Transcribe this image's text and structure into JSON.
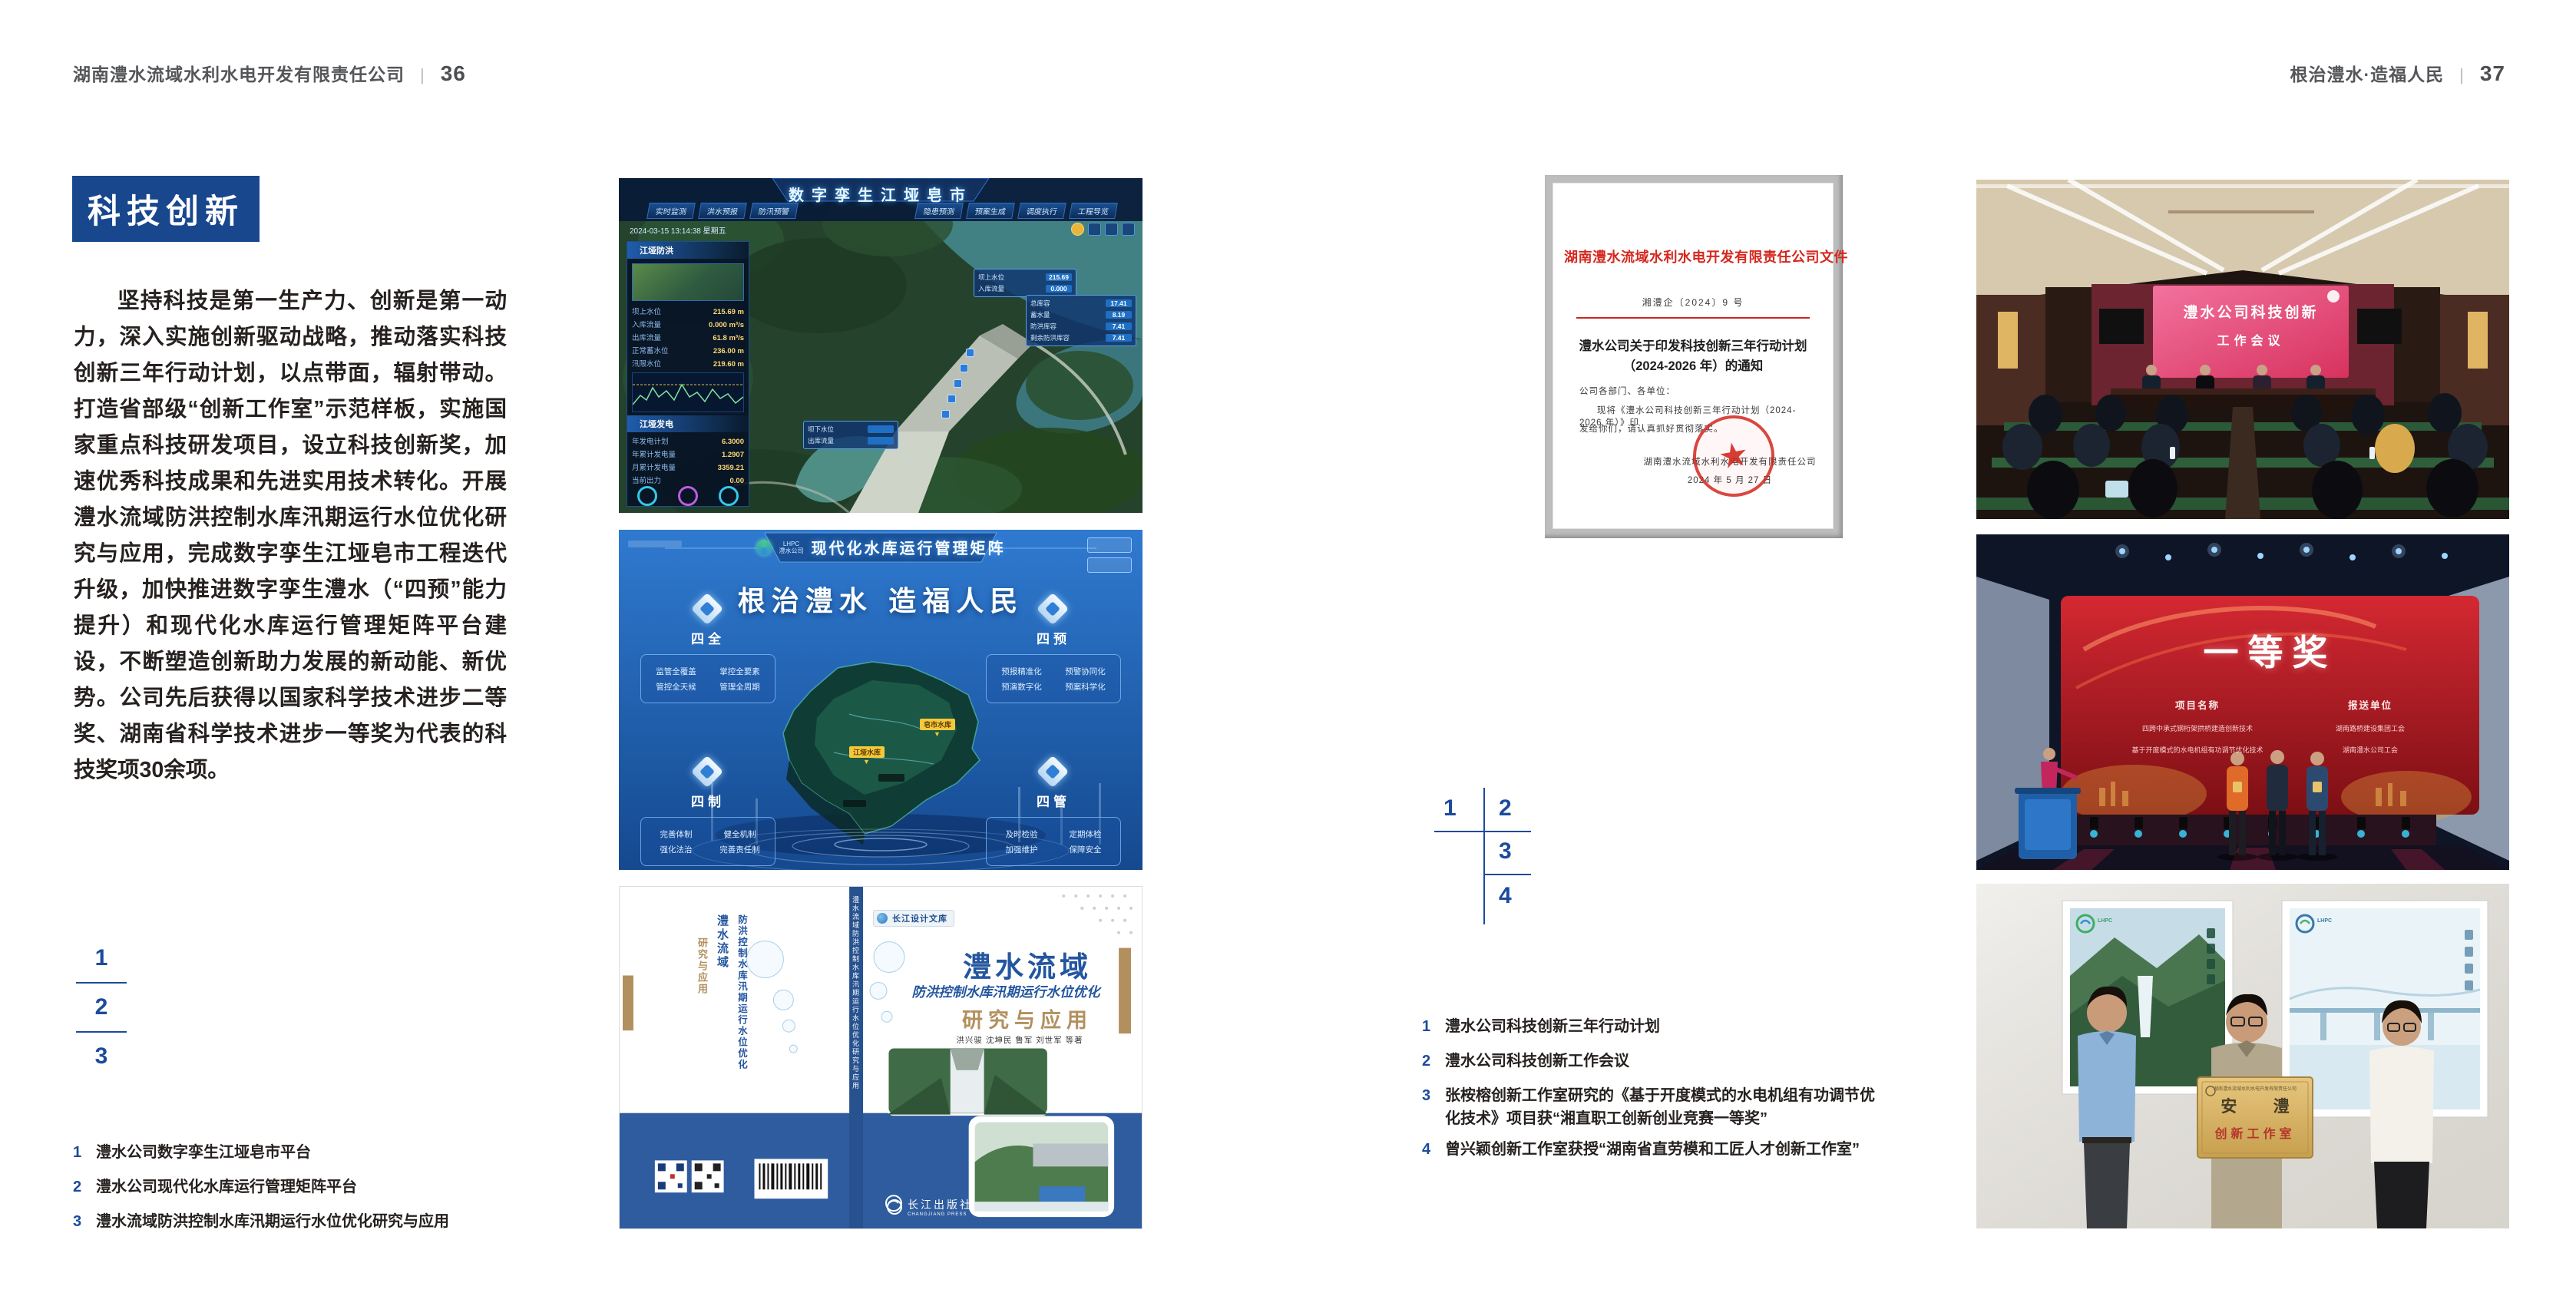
{
  "page_left": {
    "header": {
      "company": "湖南澧水流域水利水电开发有限责任公司",
      "divider": "|",
      "page_num": "36"
    },
    "section_title": "科技创新",
    "paragraph": "坚持科技是第一生产力、创新是第一动力，深入实施创新驱动战略，推动落实科技创新三年行动计划，以点带面，辐射带动。打造省部级“创新工作室”示范样板，实施国家重点科技研发项目，设立科技创新奖，加速优秀科技成果和先进实用技术转化。开展澧水流域防洪控制水库汛期运行水位优化研究与应用，完成数字孪生江垭皂市工程迭代升级，加快推进数字孪生澧水（“四预”能力提升）和现代化水库运行管理矩阵平台建设，不断塑造创新助力发展的新动能、新优势。公司先后获得以国家科学技术进步二等奖、湖南省科学技术进步一等奖为代表的科技奖项30余项。",
    "figure_index": [
      "1",
      "2",
      "3"
    ],
    "captions": [
      {
        "num": "1",
        "text": "澧水公司数字孪生江垭皂市平台"
      },
      {
        "num": "2",
        "text": "澧水公司现代化水库运行管理矩阵平台"
      },
      {
        "num": "3",
        "text": "澧水流域防洪控制水库汛期运行水位优化研究与应用"
      }
    ]
  },
  "page_right": {
    "header": {
      "slogan": "根治澧水·造福人民",
      "divider": "|",
      "page_num": "37"
    },
    "figure_index": [
      "1",
      "2",
      "3",
      "4"
    ],
    "captions": [
      {
        "num": "1",
        "text": "澧水公司科技创新三年行动计划"
      },
      {
        "num": "2",
        "text": "澧水公司科技创新工作会议"
      },
      {
        "num": "3",
        "text": "张桉榕创新工作室研究的《基于开度模式的水电机组有功调节优化技术》项目获“湘直职工创新创业竞赛一等奖”"
      },
      {
        "num": "4",
        "text": "曾兴颖创新工作室获授“湖南省直劳模和工匠人才创新工作室”"
      }
    ]
  },
  "figures": {
    "dashboard": {
      "title": "数字孪生江垭皂市",
      "timestamp": "2024-03-15 13:14:38 星期五",
      "tabs_left": [
        "实时监测",
        "洪水预报",
        "防汛预警"
      ],
      "tabs_right": [
        "隐患预测",
        "预案生成",
        "调度执行",
        "工程导览"
      ],
      "panel_flood_title": "江垭防洪",
      "panel_power_title": "江垭发电",
      "flood_stats": [
        {
          "label": "坝上水位",
          "value": "215.69 m"
        },
        {
          "label": "入库流量",
          "value": "0.000 m³/s"
        },
        {
          "label": "出库流量",
          "value": "61.8 m³/s"
        },
        {
          "label": "正常蓄水位",
          "value": "236.00 m"
        },
        {
          "label": "汛限水位",
          "value": "219.60 m"
        }
      ],
      "power_stats": [
        {
          "label": "年发电计划",
          "value": "6.3000"
        },
        {
          "label": "年累计发电量",
          "value": "1.2907"
        },
        {
          "label": "月累计发电量",
          "value": "3359.21"
        },
        {
          "label": "当前出力",
          "value": "0.00"
        }
      ],
      "info_card": [
        {
          "label": "总库容",
          "value": "17.41"
        },
        {
          "label": "蓄水量",
          "value": "8.19"
        },
        {
          "label": "防洪库容",
          "value": "7.41"
        },
        {
          "label": "剩余防洪库容",
          "value": "7.41"
        }
      ],
      "tooltip_up": [
        {
          "label": "坝上水位",
          "value": "215.69"
        },
        {
          "label": "入库流量",
          "value": "0.000"
        }
      ],
      "tooltip_down": [
        {
          "label": "坝下水位"
        },
        {
          "label": "出库流量"
        }
      ]
    },
    "matrix": {
      "logo_abbr": "LHPC",
      "logo_name": "澧水公司",
      "title": "现代化水库运行管理矩阵",
      "slogan": "根治澧水 造福人民",
      "panels": [
        {
          "name": "四全",
          "items": [
            "监管全覆盖",
            "掌控全要素",
            "管控全天候",
            "管理全周期"
          ]
        },
        {
          "name": "四预",
          "items": [
            "预报精准化",
            "预警协同化",
            "预演数字化",
            "预案科学化"
          ]
        },
        {
          "name": "四制",
          "items": [
            "完善体制",
            "健全机制",
            "强化法治",
            "完善责任制"
          ]
        },
        {
          "name": "四管",
          "items": [
            "及时检验",
            "定期体检",
            "加强维护",
            "保障安全"
          ]
        }
      ],
      "markers": [
        "江垭水库",
        "皂市水库"
      ]
    },
    "book": {
      "series_badge": "长江设计文库",
      "title_line1": "澧水流域",
      "title_line2": "防洪控制水库汛期运行水位优化",
      "title_line3": "研究与应用",
      "authors": "洪兴骏 沈坤民 鲁军 刘世军 等著",
      "publisher": "长江出版社",
      "publisher_en": "CHANGJIANG PRESS",
      "spine_title": "澧水流域防洪控制水库汛期运行水位优化研究与应用"
    },
    "document": {
      "header": "湖南澧水流域水利水电开发有限责任公司文件",
      "doc_no": "湘澧企〔2024〕9 号",
      "title_line1": "澧水公司关于印发科技创新三年行动计划",
      "title_line2": "（2024-2026 年）的通知",
      "salutation": "公司各部门、各单位：",
      "body_line1": "现将《澧水公司科技创新三年行动计划（2024-2026 年）》印",
      "body_line2": "发给你们，请认真抓好贯彻落实。",
      "signature": "湖南澧水流域水利水电开发有限责任公司",
      "date": "2024 年 5 月 27 日"
    },
    "meeting": {
      "screen_line1": "澧水公司科技创新",
      "screen_line2": "工作会议"
    },
    "award": {
      "screen_title": "一等奖",
      "columns": [
        "项目名称",
        "报送单位"
      ],
      "rows": [
        {
          "project": "四跨中承式钢桁架拱桥建造创新技术",
          "org": "湖南路桥建设集团工会"
        },
        {
          "project": "基于开度模式的水电机组有功调节优化技术",
          "org": "湖南澧水公司工会"
        }
      ]
    },
    "group": {
      "plaque_header": "湖南澧水流域水利水电开发有限责任公司",
      "plaque_title": "安 澧",
      "plaque_subtitle": "创新工作室",
      "poster_logo": "LHPC"
    }
  },
  "icons": {
    "seal_star": "★",
    "marker_pin": "▼"
  },
  "colors": {
    "navy": "#18478e",
    "index_blue": "#1c4b9c",
    "doc_red": "#d4281e",
    "gold_tan": "#b2905e"
  }
}
